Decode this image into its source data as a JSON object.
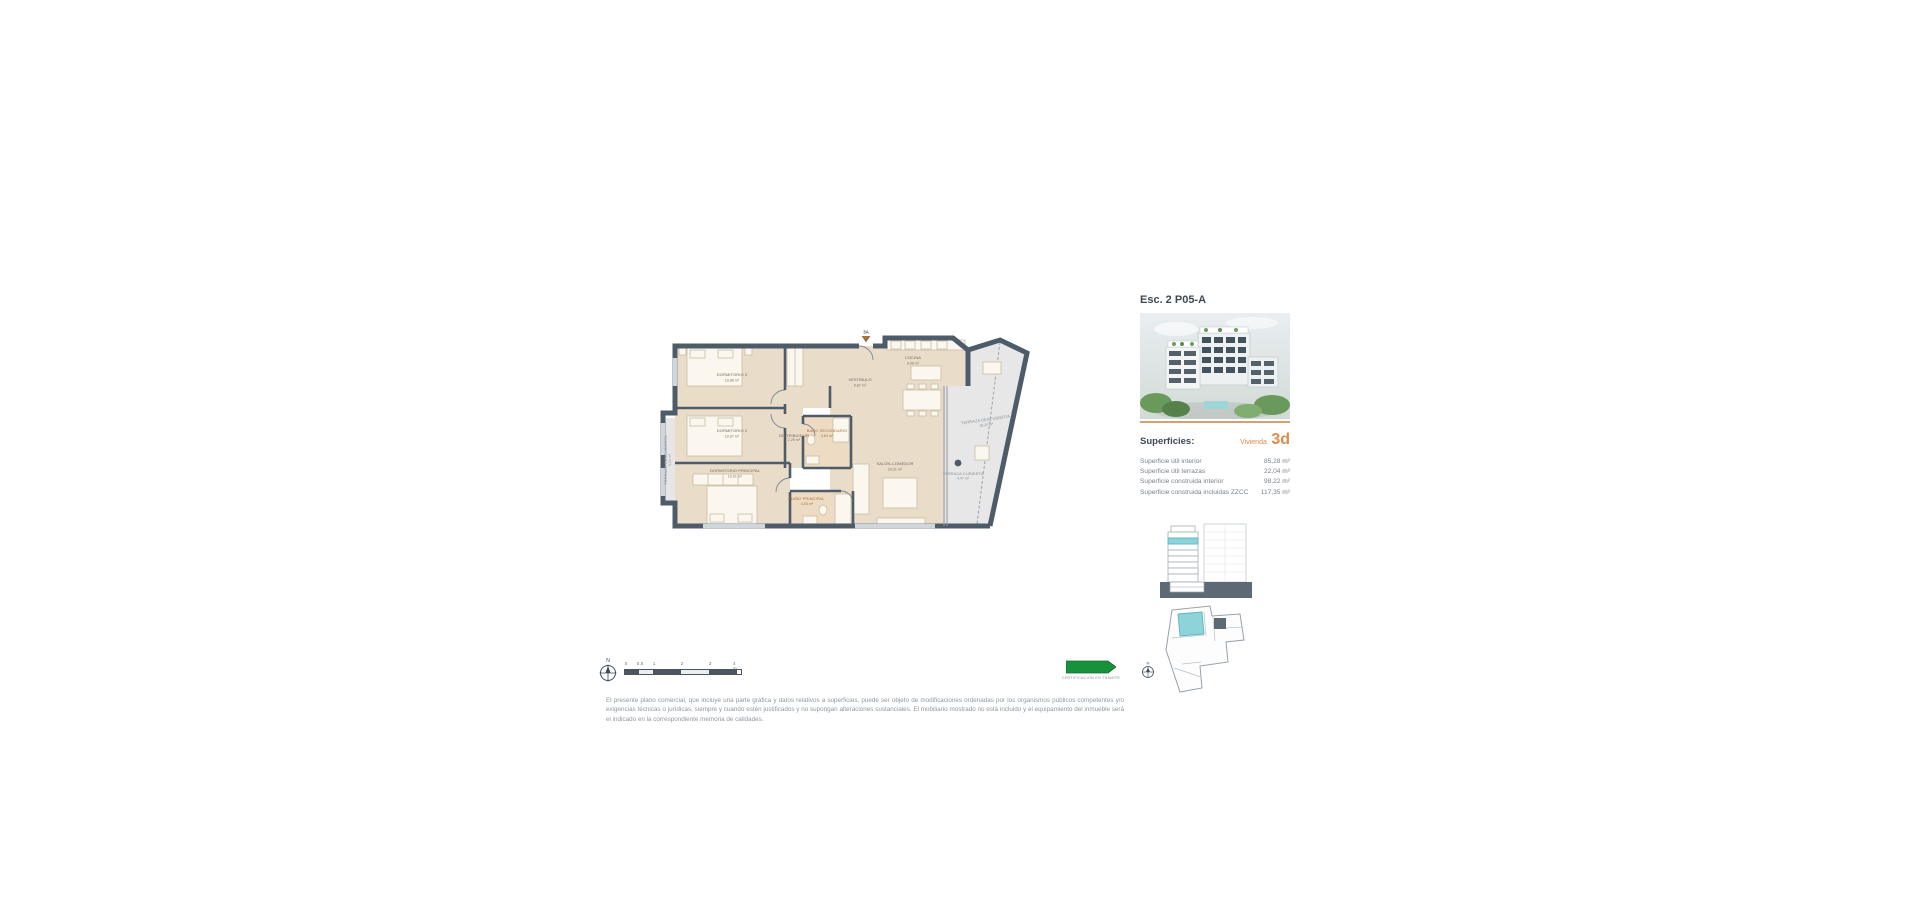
{
  "colors": {
    "wall": "#4e5c6a",
    "room_fill": "#e9dcc8",
    "bath_fill": "#eddcc3",
    "terrace_fill": "#e7e7e7",
    "accent_orange": "#e08b4a",
    "highlight_teal": "#8ed2da",
    "badge_green": "#18903c",
    "text_dark": "#3c4a55",
    "text_gray": "#9097a0"
  },
  "header": {
    "title": "Esc. 2 P05-A"
  },
  "superficies": {
    "heading": "Superficies:",
    "vivienda_label": "Vivienda",
    "vivienda_code": "3d",
    "rows": [
      {
        "label": "Superficie útil interior",
        "value": "85,28 m²"
      },
      {
        "label": "Superficie útil terrazas",
        "value": "22,04 m²"
      },
      {
        "label": "Superficie construida interior",
        "value": "98,22 m²"
      },
      {
        "label": "Superficie construida incluidas ZZCC",
        "value": "117,35 m²"
      }
    ]
  },
  "plan": {
    "entrance_label": "3A",
    "rooms": {
      "dormitorio3": {
        "name": "DORMITORIO 3",
        "area": "10,88 m²"
      },
      "dormitorio2": {
        "name": "DORMITORIO 2",
        "area": "10,07 m²"
      },
      "dormitorio_principal": {
        "name": "DORMITORIO PRINCIPAL",
        "area": "13,01 m²"
      },
      "bano_secundario": {
        "name": "BAÑO SECUNDARIO",
        "area": "3,84 m²"
      },
      "bano_principal": {
        "name": "BAÑO PRINCIPAL",
        "area": "4,03 m²"
      },
      "distribuidor": {
        "name": "DISTRIBUIDOR",
        "area": "2,29 m²"
      },
      "vestibulo": {
        "name": "VESTÍBULO",
        "area": "6,87 m²"
      },
      "cocina": {
        "name": "COCINA",
        "area": "9,96 m²"
      },
      "salon_comedor": {
        "name": "SALÓN-COMEDOR",
        "area": "23,31 m²"
      },
      "terraza_izquierda": {
        "name": "TERRAZA DESCUBIERTA",
        "area": "3,23 m²"
      },
      "terraza_derecha": {
        "name": "TERRAZA DESCUBIERTA",
        "area": "18,20 m²"
      },
      "terraza_cubierta": {
        "name": "TERRAZA CUBIERTA",
        "area": "4,47 m²"
      }
    }
  },
  "scalebar": {
    "north": "N",
    "ticks": [
      "0",
      "0,5",
      "1",
      "2",
      "3",
      "4 m"
    ]
  },
  "badge": {
    "text": "CERTIFICACIÓN EN TRÁMITE"
  },
  "disclaimer": {
    "line1": "El presente plano comercial, que incluye una parte gráfica y datos relativos a superficies, puede ser objeto de modificaciones ordenadas por los organismos públicos competentes y/o exigencias técnicas o jurídicas, siempre y",
    "line2": "cuando estén justificados y no supongan alteraciones sustanciales. El mobiliario mostrado no está incluido y el equipamiento del inmueble será el indicado en la correspondiente memoria de calidades."
  }
}
